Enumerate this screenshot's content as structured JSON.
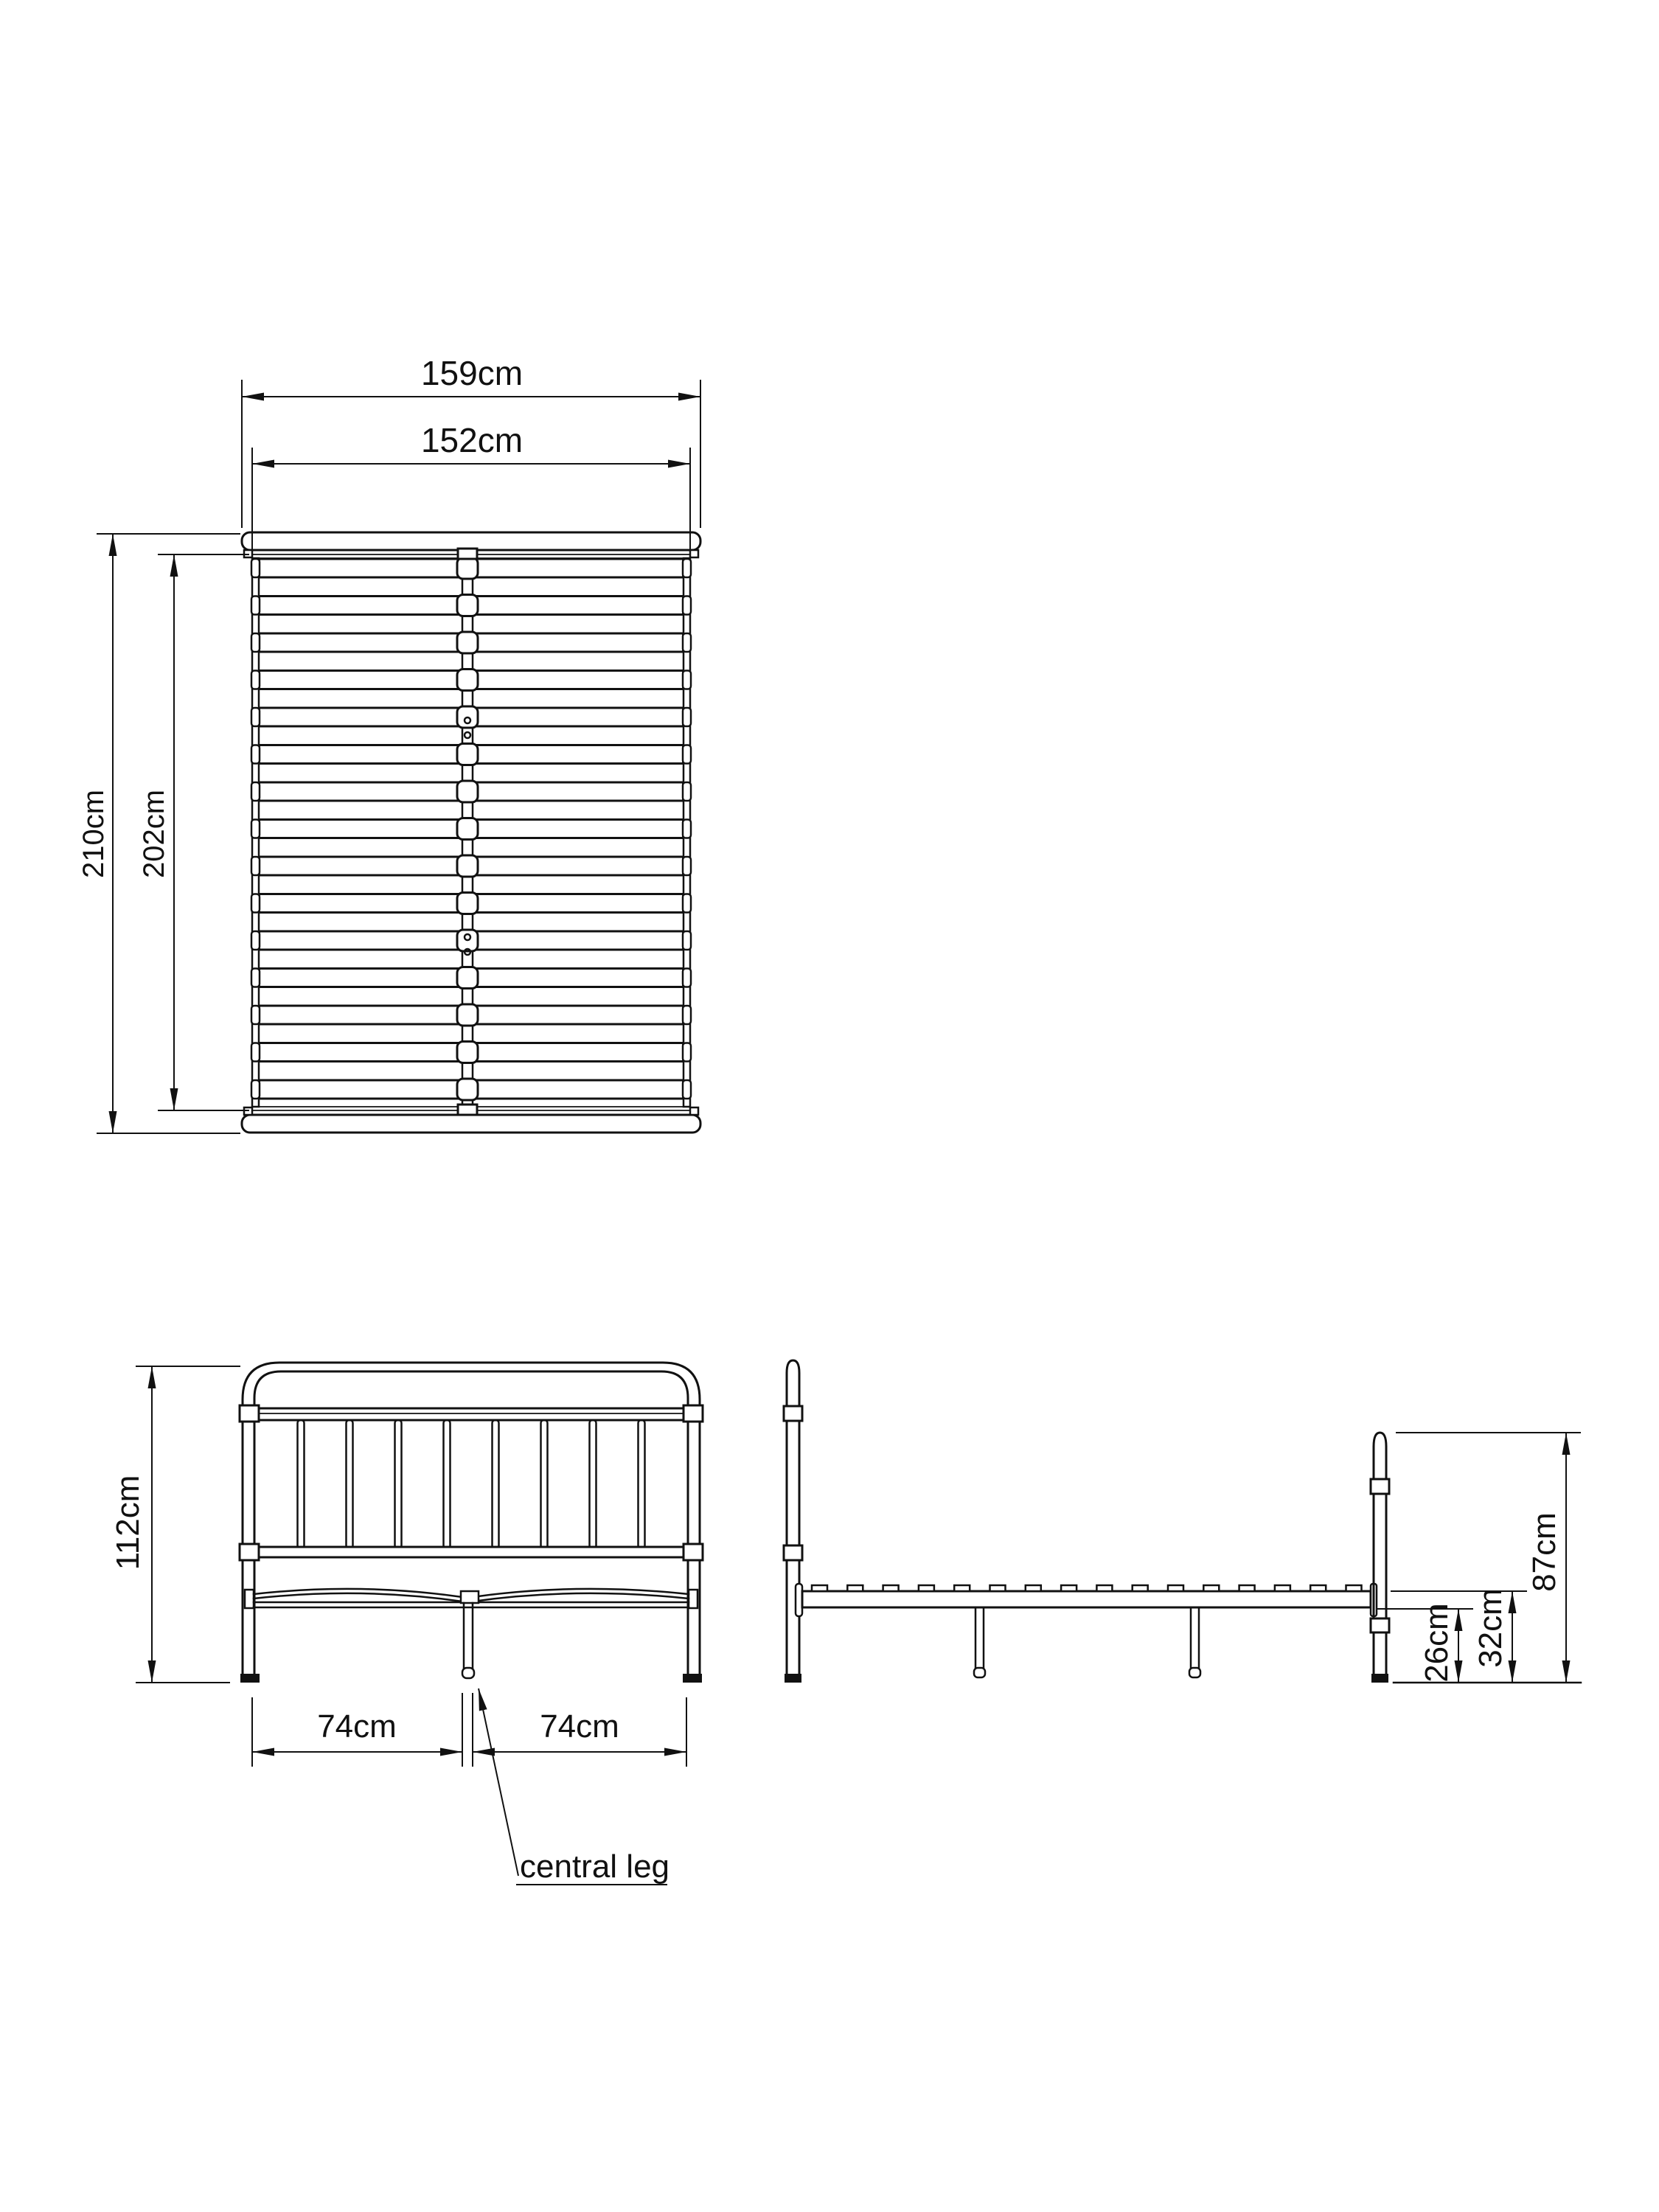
{
  "drawing": {
    "kind": "furniture dimension diagram",
    "subject": "metal bed frame with slatted base",
    "background_color": "#ffffff",
    "line_color": "#111111"
  },
  "top_view": {
    "outer_width_label": "159cm",
    "inner_width_label": "152cm",
    "outer_length_label": "210cm",
    "inner_length_label": "202cm",
    "slat_count": 15,
    "bolt_hole_count": 4
  },
  "front_view": {
    "height_label": "112cm",
    "left_half_label": "74cm",
    "right_half_label": "74cm",
    "callout_label": "central leg",
    "headboard_bar_count": 8
  },
  "side_view": {
    "footboard_height_label": "87cm",
    "platform_height_label": "32cm",
    "clearance_height_label": "26cm",
    "slat_tab_count": 16,
    "mid_leg_count": 2
  }
}
